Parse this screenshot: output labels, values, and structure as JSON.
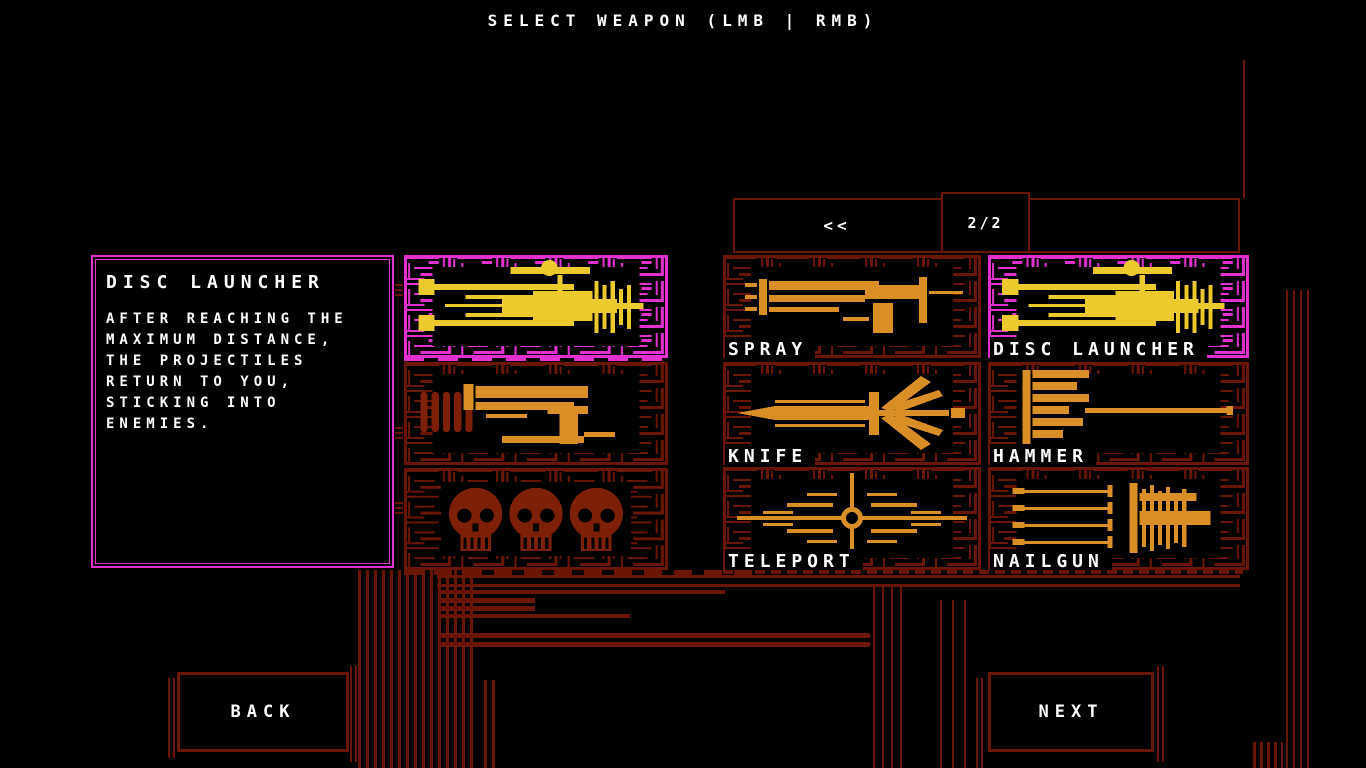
{
  "title": "SELECT WEAPON (LMB | RMB)",
  "description_panel": {
    "weapon_name": "DISC LAUNCHER",
    "description_lines": [
      "AFTER REACHING THE",
      "MAXIMUM DISTANCE,",
      "THE PROJECTILES",
      "RETURN TO YOU,",
      "STICKING INTO",
      "ENEMIES."
    ]
  },
  "loadout_slots": [
    {
      "name": "disc-launcher",
      "selected": true
    },
    {
      "name": "pistol",
      "selected": false
    },
    {
      "name": "skulls",
      "selected": false
    }
  ],
  "pagination": {
    "prev_label": "<<",
    "page_indicator": "2/2"
  },
  "weapon_grid": [
    {
      "label": "SPRAY",
      "selected": false
    },
    {
      "label": "DISC LAUNCHER",
      "selected": true
    },
    {
      "label": "KNIFE",
      "selected": false
    },
    {
      "label": "HAMMER",
      "selected": false
    },
    {
      "label": "TELEPORT",
      "selected": false
    },
    {
      "label": "NAILGUN",
      "selected": false
    }
  ],
  "footer": {
    "back_label": "BACK",
    "next_label": "NEXT"
  },
  "colors": {
    "magenta": "#e331d1",
    "yellow": "#ecc92d",
    "orange": "#d98f26",
    "dark_red": "#6b1604",
    "dark_red_bright": "#7d2007",
    "white": "#ffffff",
    "background": "#000000"
  }
}
